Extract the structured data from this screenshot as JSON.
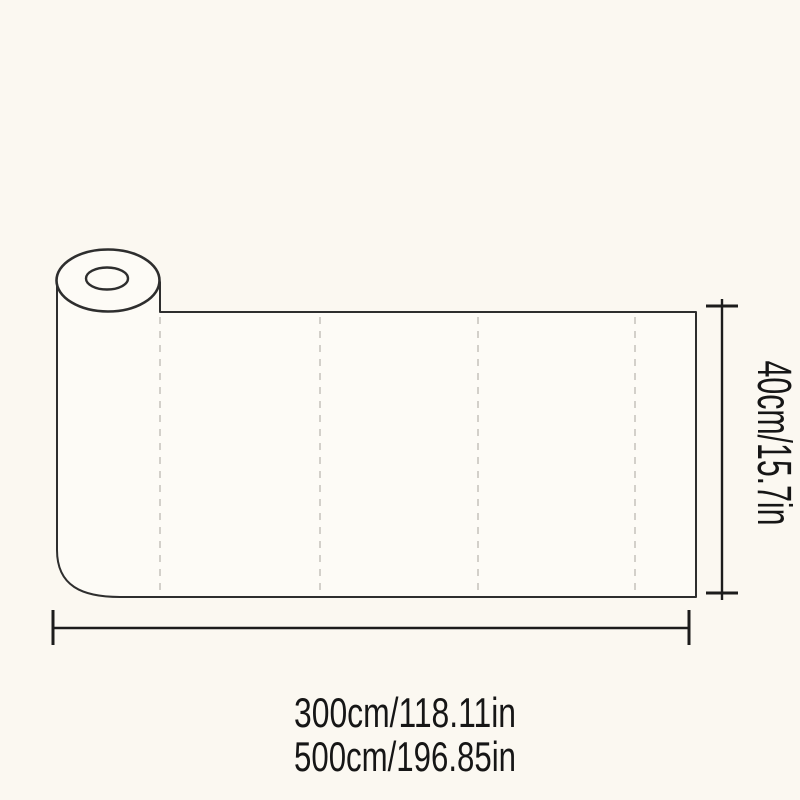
{
  "page": {
    "background_color": "#FBF8F1",
    "sheet_fill_color": "#FDFBF6",
    "outline_color": "#2E2E2E",
    "dimension_line_color": "#1C1C1C",
    "fold_dash_color": "#C9C6BF",
    "text_color": "#161616"
  },
  "diagram": {
    "description": "roll of material unrolled into a flat sheet with dimension arrows",
    "height_label": "40cm/15.7in",
    "length_label_300": "300cm/118.11in",
    "length_label_500": "500cm/196.85in"
  }
}
